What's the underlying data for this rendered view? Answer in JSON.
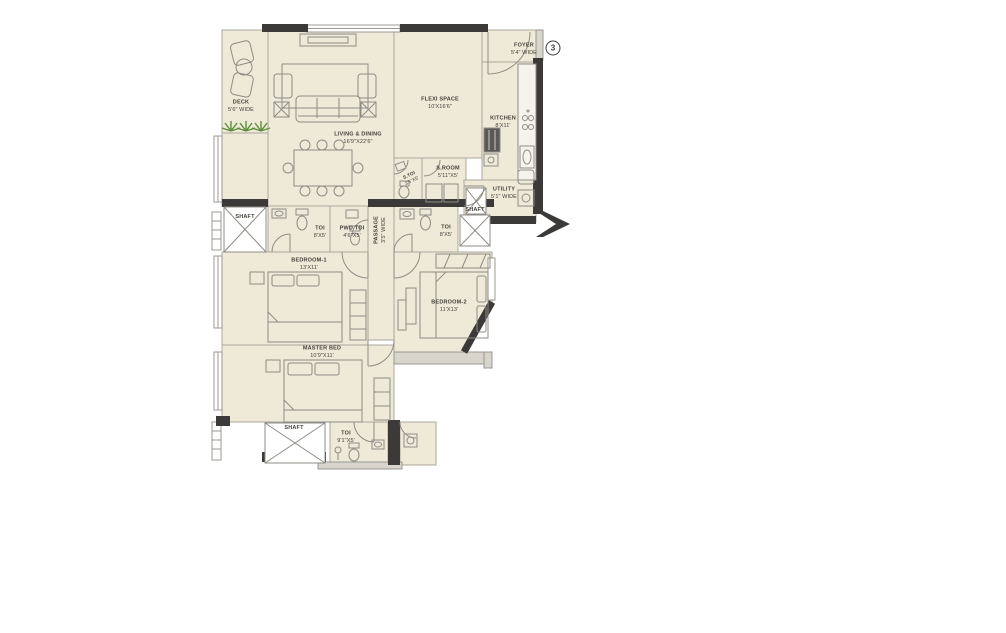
{
  "badge": {
    "number": "3"
  },
  "rooms": {
    "deck": {
      "name": "DECK",
      "dim": "5'6\" WIDE"
    },
    "living_dining": {
      "name": "LIVING & DINING",
      "dim": "16'9\"X22'6\""
    },
    "flexi_space": {
      "name": "FLEXI SPACE",
      "dim": "10'X16'6\""
    },
    "foyer": {
      "name": "FOYER",
      "dim": "5'4\" WIDE"
    },
    "kitchen": {
      "name": "KITCHEN",
      "dim": "8'X11'"
    },
    "s_toi": {
      "name": "S.TOI",
      "dim": "3'5\"X5'"
    },
    "s_room": {
      "name": "S.ROOM",
      "dim": "5'11\"X5'"
    },
    "utility": {
      "name": "UTILITY",
      "dim": "5'1\" WIDE"
    },
    "shaft_left": {
      "name": "SHAFT"
    },
    "toi_bedroom1": {
      "name": "TOI",
      "dim": "8'X5'"
    },
    "pwd_toi": {
      "name": "PWD TOI",
      "dim": "4'6\"X5'"
    },
    "passage": {
      "name": "PASSAGE",
      "dim": "3'5\" WIDE"
    },
    "toi_bedroom2": {
      "name": "TOI",
      "dim": "8'X5'"
    },
    "shaft_right": {
      "name": "SHAFT"
    },
    "bedroom_1": {
      "name": "BEDROOM-1",
      "dim": "13'X11'"
    },
    "bedroom_2": {
      "name": "BEDROOM-2",
      "dim": "11'X13'"
    },
    "master_bed": {
      "name": "MASTER BED",
      "dim": "10'9\"X11'"
    },
    "shaft_bottom": {
      "name": "SHAFT"
    },
    "toi_master": {
      "name": "TOI",
      "dim": "9'1\"X5'"
    }
  },
  "colors": {
    "floor": "#EFE9D8",
    "wall_dark": "#3B3A38",
    "wall_light": "#A9A6A0",
    "sill_gray": "#D8D5CD",
    "plant_green": "#5E8F3C",
    "background": "#FFFFFF"
  }
}
